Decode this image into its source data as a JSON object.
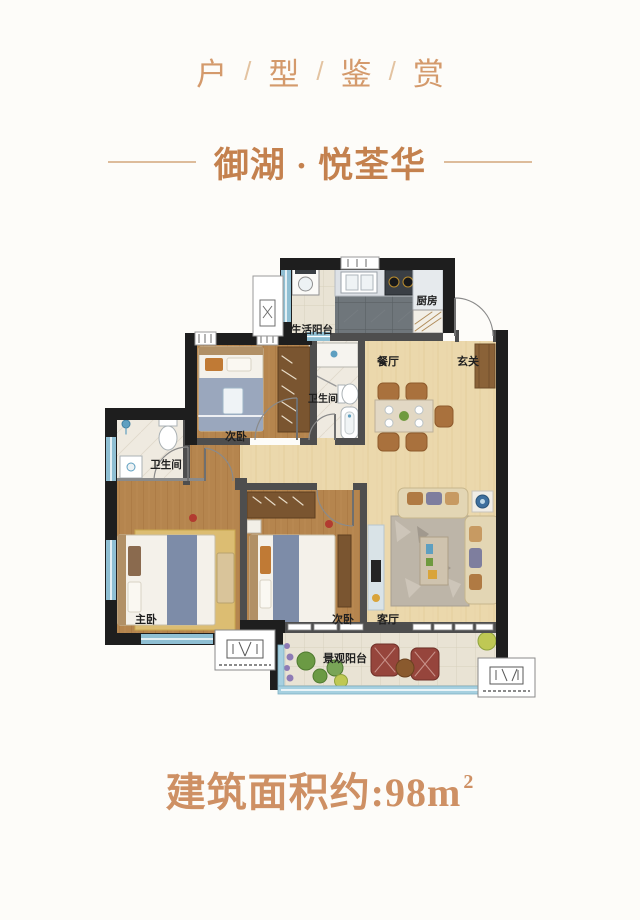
{
  "header": {
    "series_title": {
      "chars": [
        "户",
        "型",
        "鉴",
        "赏"
      ],
      "divider": "/"
    },
    "project_name": "御湖 · 悦荃华"
  },
  "floorplan": {
    "labels": [
      {
        "id": "service-balcony",
        "text": "生活阳台"
      },
      {
        "id": "kitchen",
        "text": "厨房"
      },
      {
        "id": "dining",
        "text": "餐厅"
      },
      {
        "id": "entry",
        "text": "玄关"
      },
      {
        "id": "bathroom-2",
        "text": "卫生间"
      },
      {
        "id": "bedroom-2a",
        "text": "次卧"
      },
      {
        "id": "bathroom-1",
        "text": "卫生间"
      },
      {
        "id": "master-bedroom",
        "text": "主卧"
      },
      {
        "id": "bedroom-2b",
        "text": "次卧"
      },
      {
        "id": "living-room",
        "text": "客厅"
      },
      {
        "id": "view-balcony",
        "text": "景观阳台"
      }
    ]
  },
  "footer": {
    "area_prefix": "建筑面积约:",
    "area_value": "98",
    "area_unit": "m",
    "area_exponent": "2"
  },
  "colors": {
    "accent_light": "#D49A6C",
    "accent_deep": "#C4814E",
    "divider_line": "#DDBC9B",
    "label_text": "#1F1F1F",
    "wall_black": "#1E1E1E",
    "wall_gray": "#4E4E4E",
    "wood_light": "#EBD8AC",
    "wood_dark": "#B5854E",
    "kitchen_tile": "#6F767B",
    "balcony_tile": "#E9E3D4",
    "window_blue": "#8FBFD3"
  }
}
